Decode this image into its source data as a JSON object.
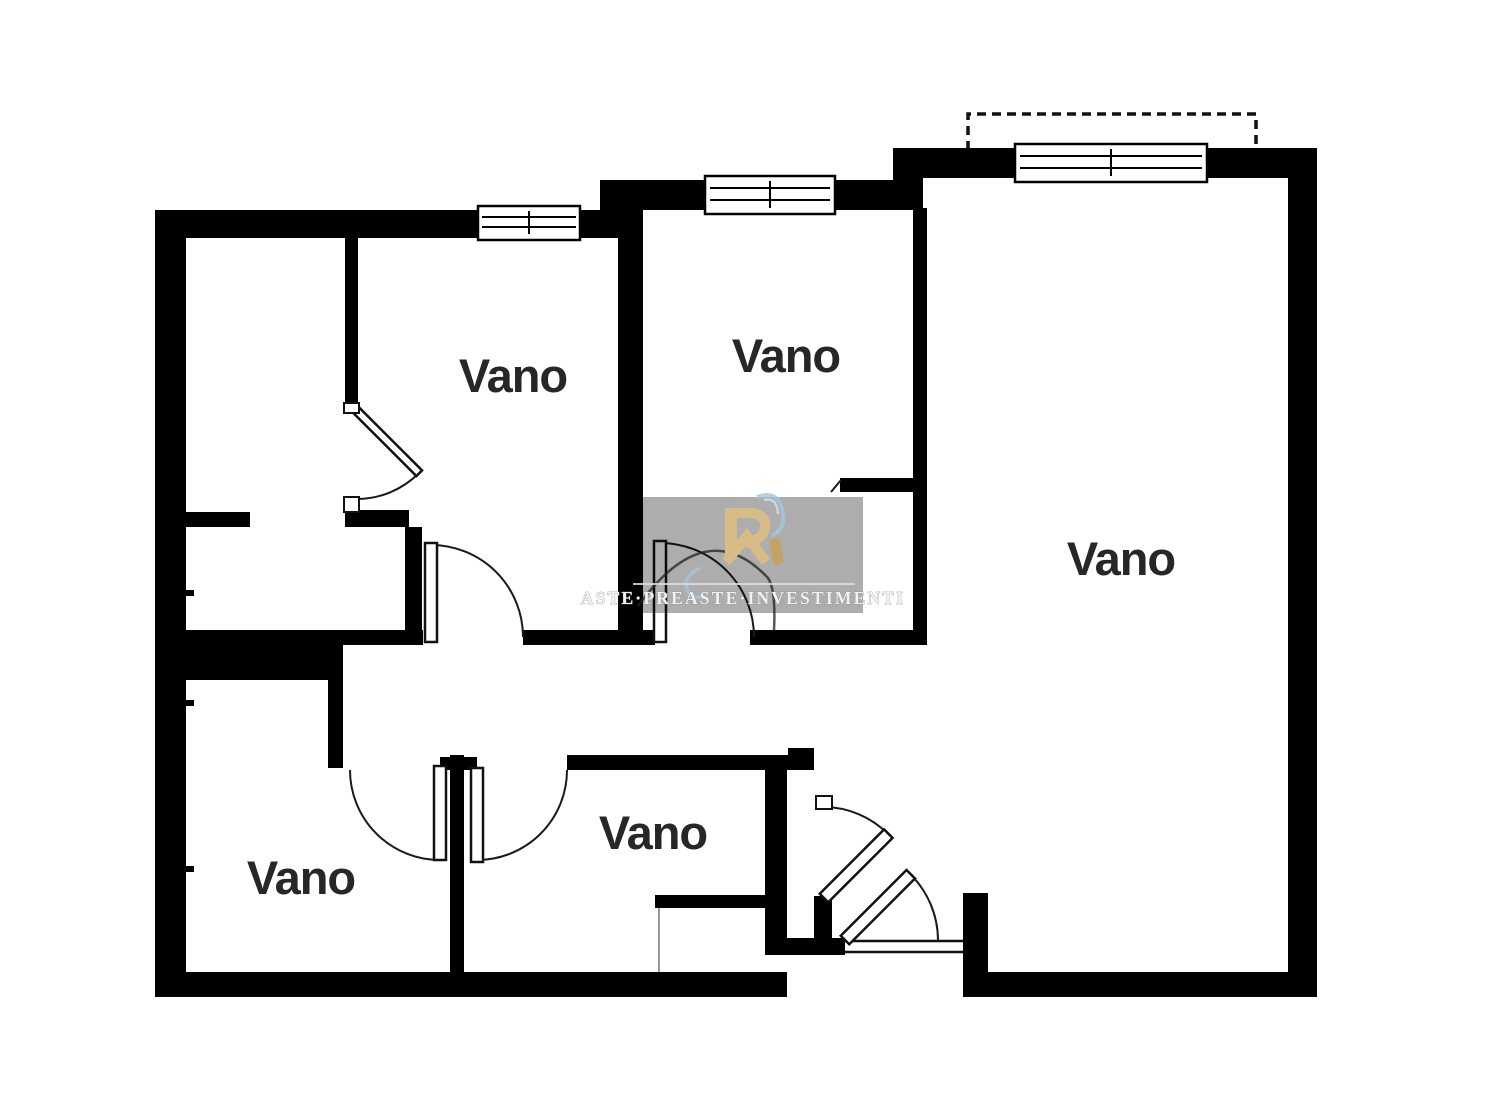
{
  "rooms": [
    {
      "id": "top-left-mid",
      "label": "Vano"
    },
    {
      "id": "top-middle",
      "label": "Vano"
    },
    {
      "id": "right-large",
      "label": "Vano"
    },
    {
      "id": "bottom-left",
      "label": "Vano"
    },
    {
      "id": "bottom-middle",
      "label": "Vano"
    }
  ],
  "watermark": {
    "text": "ASTE·PREASTE·INVESTIMENTI",
    "monogram": "R",
    "panel_color": "#a9a9a9",
    "text_color": "#f2f2f2",
    "gold": "#d8bc85",
    "gold_dark": "#c3a264",
    "blue": "#a4c6e1"
  },
  "colors": {
    "walls": "#000000",
    "label": "#272727",
    "arc": "#1a1a1a",
    "background": "#ffffff"
  }
}
